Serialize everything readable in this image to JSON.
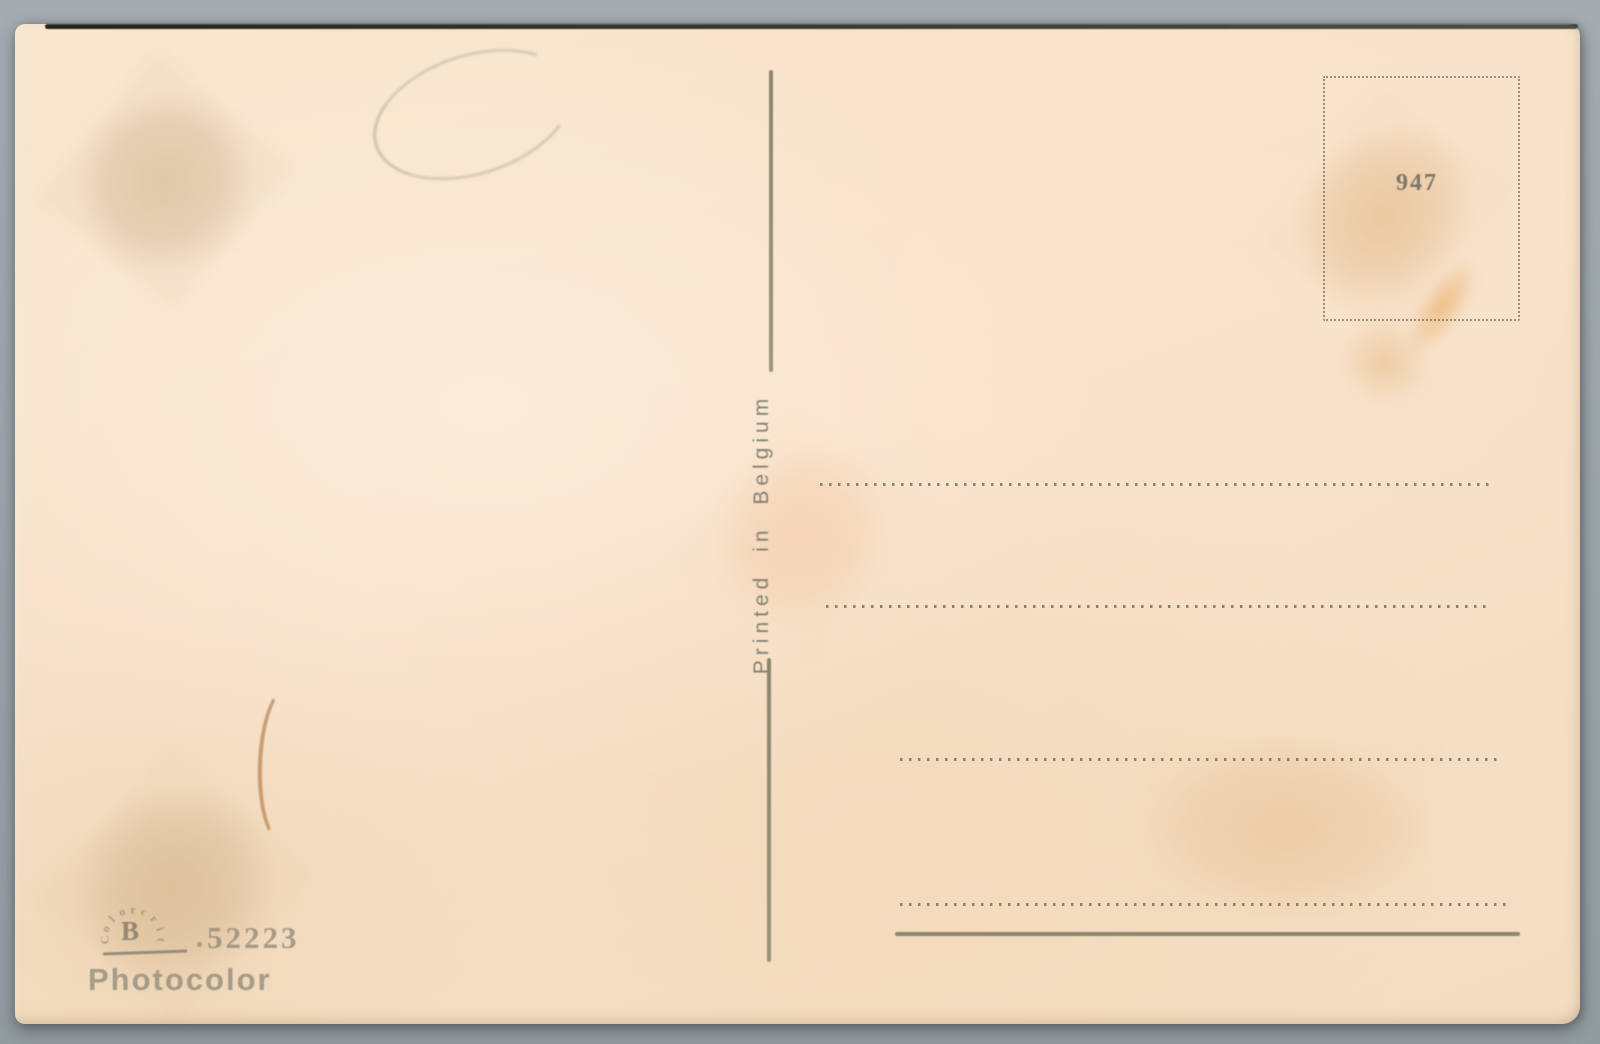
{
  "scan": {
    "background_color": "#9aa3a8",
    "paper_color": "#f7e3cb",
    "ink_color": "#7a7766",
    "stain_color": "#d9ae7a",
    "rust_mark_color": "#a8662a"
  },
  "postcard": {
    "printed_in_label": "Printed in Belgium",
    "stamp_box": {
      "number": "947"
    },
    "address_line_styles": [
      "dotted",
      "dotted",
      "dotted",
      "dotted",
      "solid"
    ],
    "publisher": {
      "arc_letters": [
        "C",
        "o",
        "l",
        "o",
        "r",
        "c",
        "r",
        "i",
        "t"
      ],
      "monogram": "B",
      "separator_dot": "",
      "serial_number": "52223",
      "name": "Photocolor"
    }
  }
}
